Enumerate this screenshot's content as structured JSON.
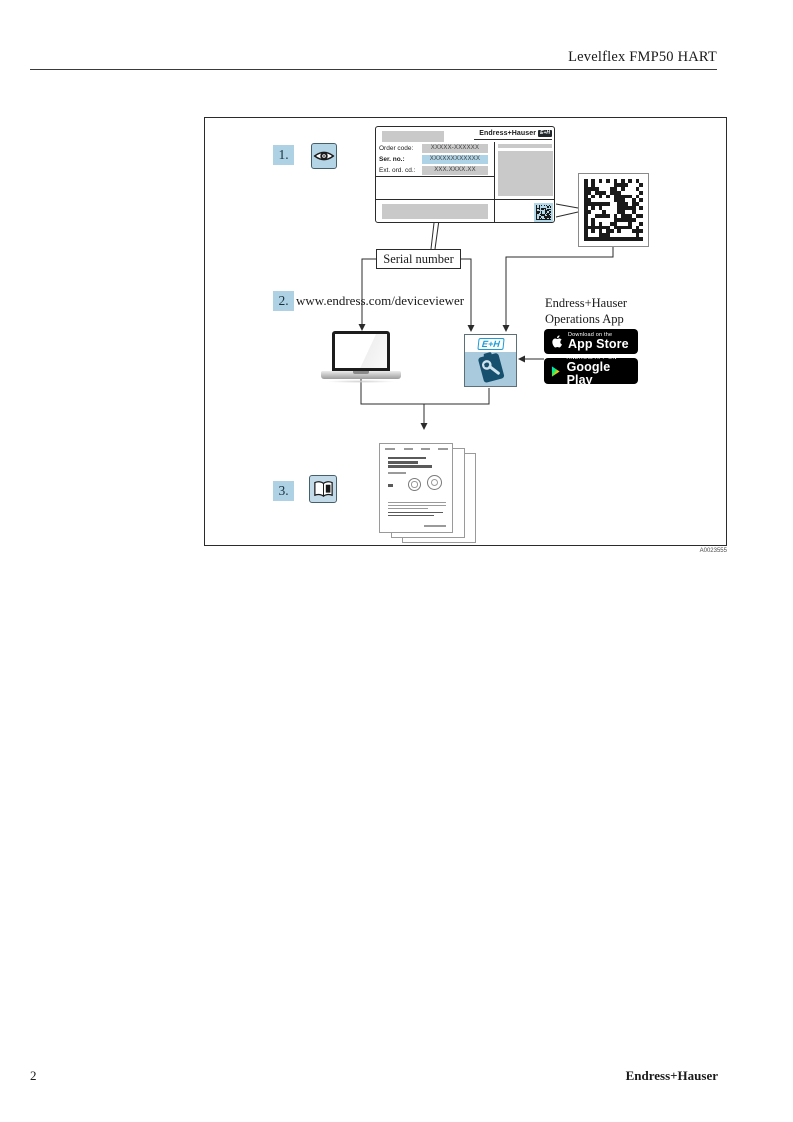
{
  "page": {
    "header_title": "Levelflex FMP50 HART",
    "figure_code": "A0023555",
    "footer_page_number": "2",
    "footer_brand": "Endress+Hauser"
  },
  "diagram": {
    "steps": {
      "one": "1.",
      "two": "2.",
      "three": "3."
    },
    "step2_url": "www.endress.com/deviceviewer",
    "serial_number_label": "Serial number",
    "nameplate": {
      "brand": "Endress+Hauser",
      "brand_logo": "E+H",
      "fields": [
        {
          "label": "Order code:",
          "value": "XXXXX-XXXXXX",
          "highlight": false
        },
        {
          "label": "Ser. no.:",
          "value": "XXXXXXXXXXXX",
          "highlight": true
        },
        {
          "label": "Ext. ord. cd.:",
          "value": "XXX.XXXX.XX",
          "highlight": false
        }
      ]
    },
    "app": {
      "title_line1": "Endress+Hauser",
      "title_line2": "Operations App",
      "icon_logo": "E+H",
      "badges": {
        "app_store": {
          "line1": "Download on the",
          "line2": "App Store"
        },
        "google_play": {
          "line1": "ANDROID APP ON",
          "line2": "Google Play"
        }
      }
    },
    "icons": {
      "step1": "eye-icon",
      "step3": "open-book-icon",
      "qr": "data-matrix-code",
      "devices": [
        "laptop-icon",
        "operations-app-icon"
      ]
    }
  },
  "colors": {
    "step_highlight": "#aed2e4",
    "field_highlight": "#aed3e6",
    "eh_blue": "#1b9cd8",
    "app_icon_blue": "#a9cadc",
    "badge_black": "#000000",
    "placeholder_gray": "#c9c9c9"
  }
}
